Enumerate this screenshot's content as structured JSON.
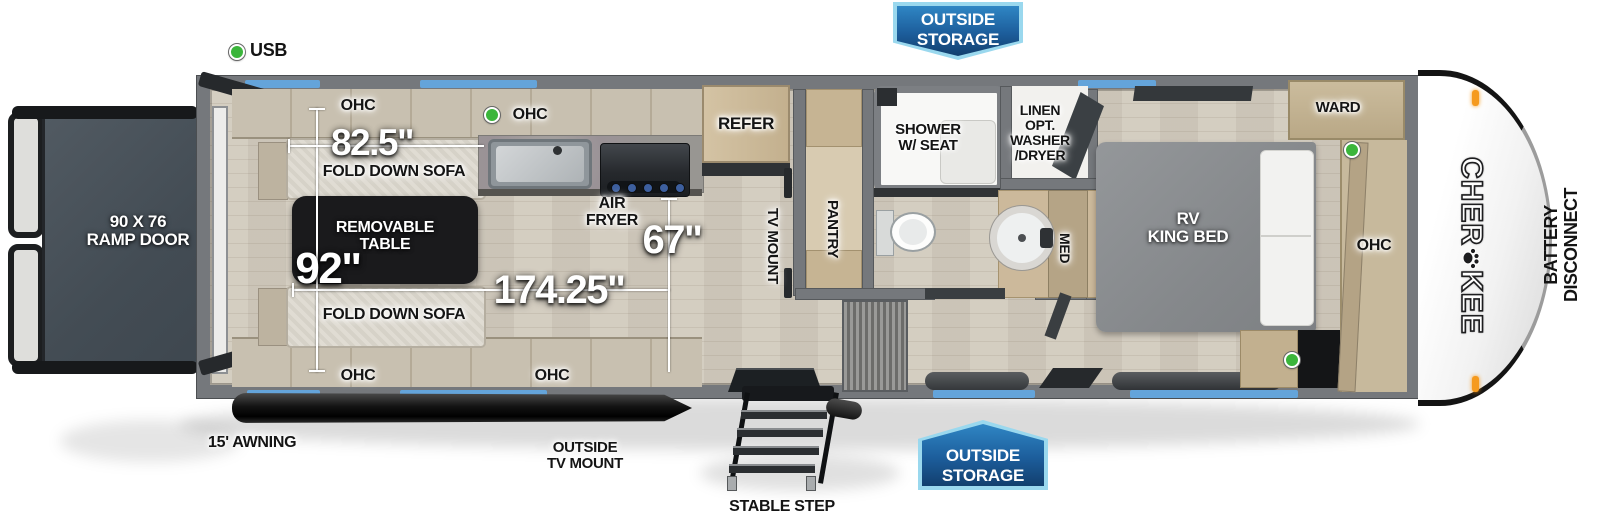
{
  "annotations": {
    "usb": "USB",
    "outside_storage_top": "OUTSIDE\nSTORAGE",
    "outside_storage_bottom": "OUTSIDE\nSTORAGE",
    "awning": "15' AWNING",
    "outside_tv_mount": "OUTSIDE\nTV MOUNT",
    "stable_step": "STABLE STEP",
    "battery_disconnect": "BATTERY\nDISCONNECT"
  },
  "rear_cargo": {
    "ramp_door": "90 X 76\nRAMP DOOR",
    "fold_down_sofa_top": "FOLD DOWN SOFA",
    "fold_down_sofa_bottom": "FOLD DOWN SOFA",
    "removable_table": "REMOVABLE\nTABLE",
    "ohc_top": "OHC",
    "ohc_top_2": "OHC",
    "ohc_bottom": "OHC",
    "ohc_bottom_2": "OHC",
    "dims": {
      "sofa_width": "82.5\"",
      "garage_width": "92\"",
      "cargo_length": "174.25\"",
      "kitchen_width": "67\""
    }
  },
  "kitchen": {
    "air_fryer": "AIR\nFRYER",
    "refer": "REFER",
    "tv_mount": "TV MOUNT",
    "pantry": "PANTRY"
  },
  "bathroom": {
    "shower": "SHOWER\nW/ SEAT",
    "linen": "LINEN\nOPT.\nWASHER\n/DRYER",
    "med": "MED"
  },
  "bedroom": {
    "bed": "RV\nKING BED",
    "ward": "WARD",
    "ohc": "OHC"
  },
  "brand": {
    "part1": "CHER",
    "part2": "KEE",
    "paw_icon": "paw-icon"
  },
  "colors": {
    "window_blue": "#64a4da",
    "banner_blue_dark": "#123f6e",
    "banner_blue_light": "#9ad8ee",
    "usb_green": "#3bb53b",
    "marker_orange": "#f59a1e"
  }
}
